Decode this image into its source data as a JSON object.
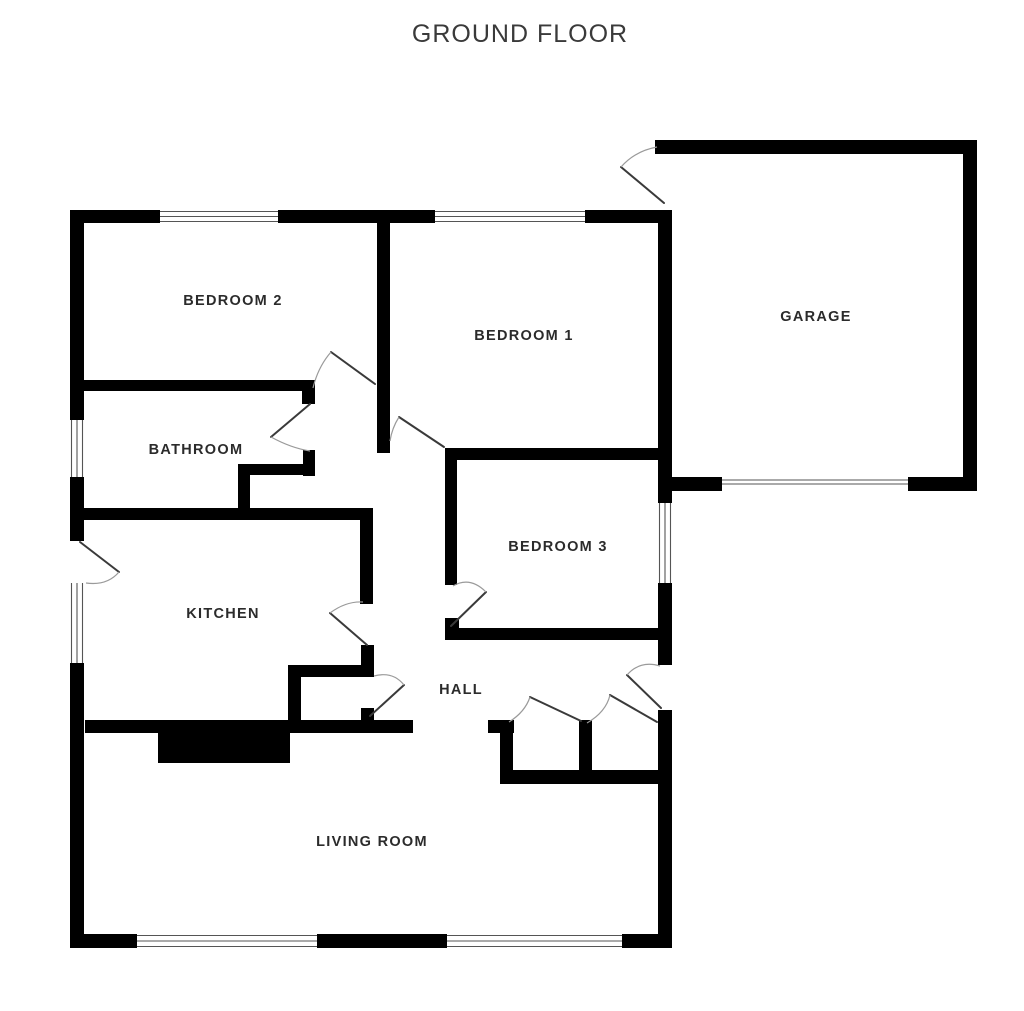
{
  "title": "GROUND FLOOR",
  "rooms": [
    {
      "name": "bedroom-2",
      "label": "BEDROOM 2"
    },
    {
      "name": "bedroom-1",
      "label": "BEDROOM 1"
    },
    {
      "name": "garage",
      "label": "GARAGE"
    },
    {
      "name": "bathroom",
      "label": "BATHROOM"
    },
    {
      "name": "bedroom-3",
      "label": "BEDROOM 3"
    },
    {
      "name": "kitchen",
      "label": "KITCHEN"
    },
    {
      "name": "hall",
      "label": "HALL"
    },
    {
      "name": "living-room",
      "label": "LIVING ROOM"
    }
  ],
  "colors": {
    "wall": "#000000",
    "background": "#ffffff",
    "label_text": "#2b2b2b",
    "title_text": "#3a3a3a",
    "door_arc": "#9a9a9a"
  }
}
